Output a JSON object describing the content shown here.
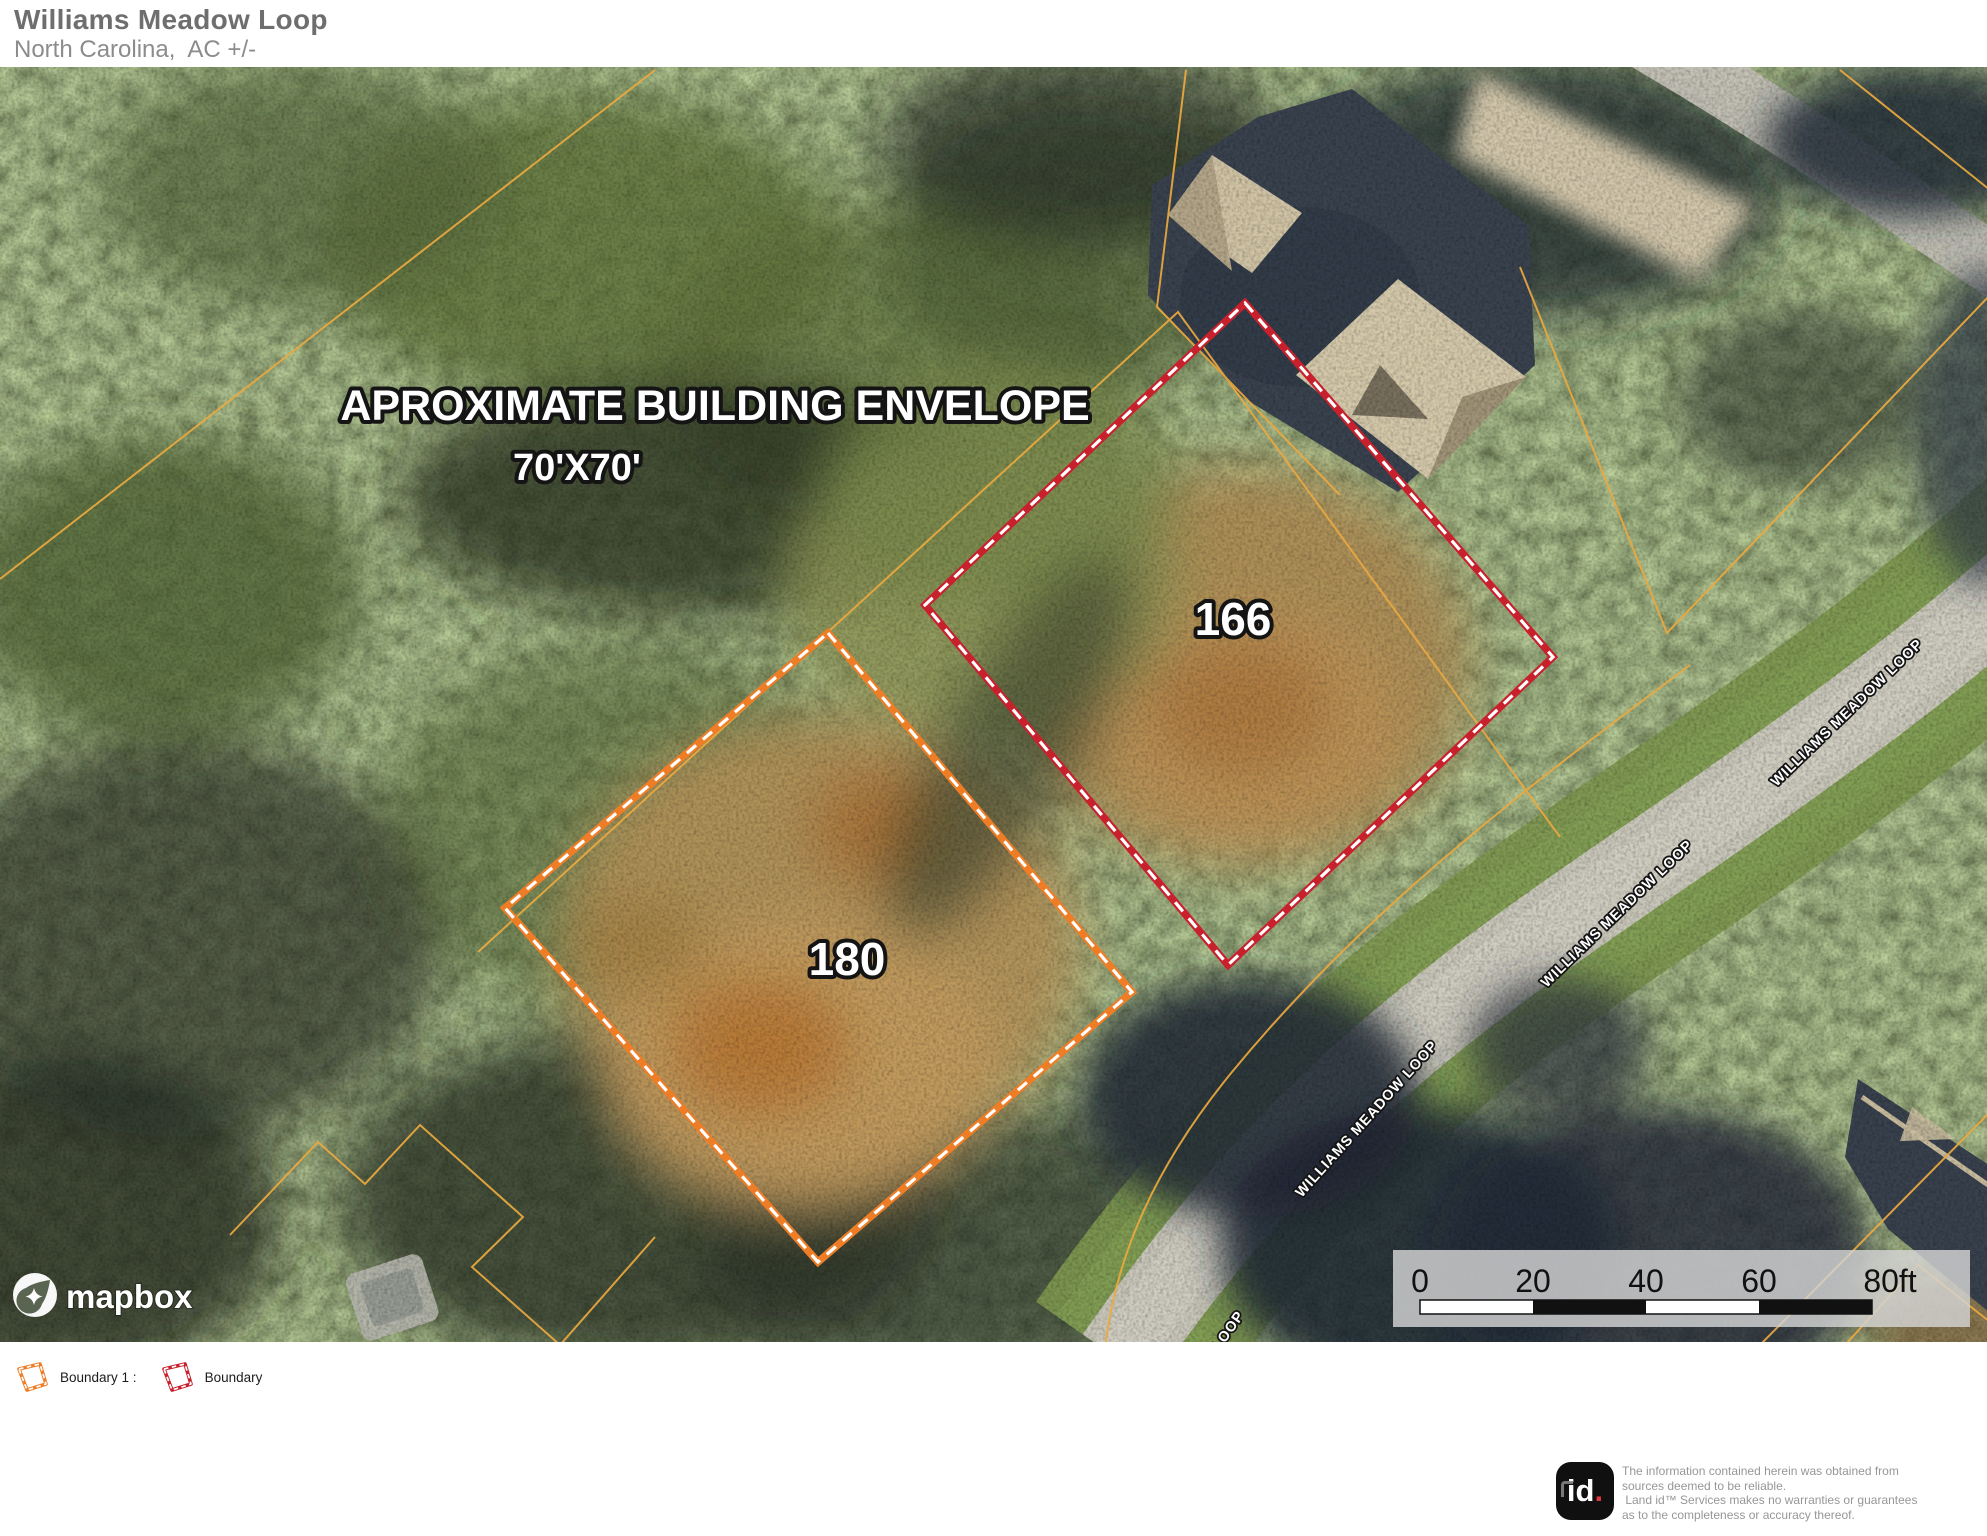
{
  "header": {
    "title": "Williams Meadow Loop",
    "subtitle": "North Carolina,  AC +/-"
  },
  "map": {
    "annotation": {
      "line1": "APROXIMATE BUILDING ENVELOPE",
      "line2": "70'X70'"
    },
    "lots": [
      {
        "label": "166"
      },
      {
        "label": "180"
      }
    ],
    "road_label": "WILLIAMS MEADOW LOOP",
    "attribution": "mapbox",
    "scalebar": {
      "ticks": [
        "0",
        "20",
        "40",
        "60"
      ],
      "end_label": "80ft"
    }
  },
  "legend": {
    "items": [
      {
        "label": "Boundary 1 :",
        "color": "#ee7d26"
      },
      {
        "label": "Boundary",
        "color": "#c8202c"
      }
    ]
  },
  "colors": {
    "boundary1": "#ee7d26",
    "boundary2": "#c8202c",
    "parcel_line": "#eba93f"
  },
  "footer": {
    "logo_text": "id",
    "logo_dot": ".",
    "disclaimer_lines": [
      "The information contained herein was obtained from",
      "sources deemed to be reliable.",
      " Land id™ Services makes no warranties or guarantees",
      "as to the completeness or accuracy thereof."
    ]
  }
}
